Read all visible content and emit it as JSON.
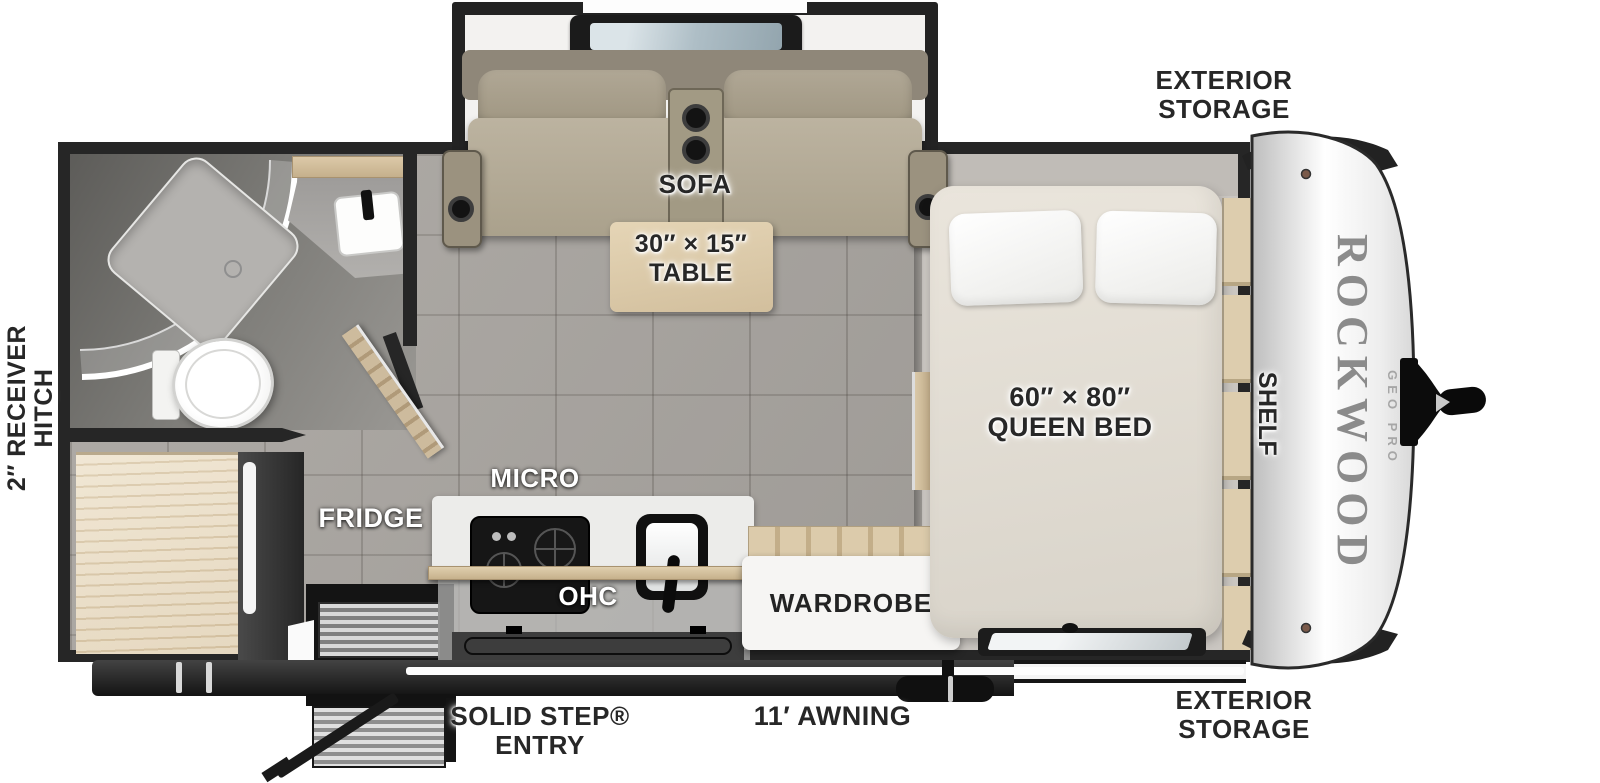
{
  "meta": {
    "title": "Rockwood Geo Pro travel trailer floor plan"
  },
  "brand": {
    "name": "ROCKWOOD",
    "model": "GEO PRO"
  },
  "colors": {
    "wall": "#262626",
    "floor_tile": "#a7a39e",
    "bed_platform": "#cac6c1",
    "wood": "#dccbab",
    "sofa": "#b0a795",
    "mattress": "#e4dfd6",
    "counter": "#ececea",
    "label_dark": "#272727",
    "label_light": "#ffffff"
  },
  "labels": {
    "exterior_storage_top": {
      "line1": "EXTERIOR",
      "line2": "STORAGE"
    },
    "exterior_storage_bottom": {
      "line1": "EXTERIOR",
      "line2": "STORAGE"
    },
    "receiver_hitch": {
      "line1": "2″ RECEIVER",
      "line2": "HITCH"
    },
    "sofa": "SOFA",
    "table": {
      "line1": "30″ × 15″",
      "line2": "TABLE"
    },
    "queen_bed": {
      "line1": "60″ × 80″",
      "line2": "QUEEN BED"
    },
    "shelf": "SHELF",
    "micro": "MICRO",
    "ohc": "OHC",
    "fridge": "FRIDGE",
    "wardrobe": "WARDROBE",
    "solid_step_entry": {
      "line1": "SOLID STEP®",
      "line2": "ENTRY"
    },
    "awning": "11′ AWNING"
  }
}
